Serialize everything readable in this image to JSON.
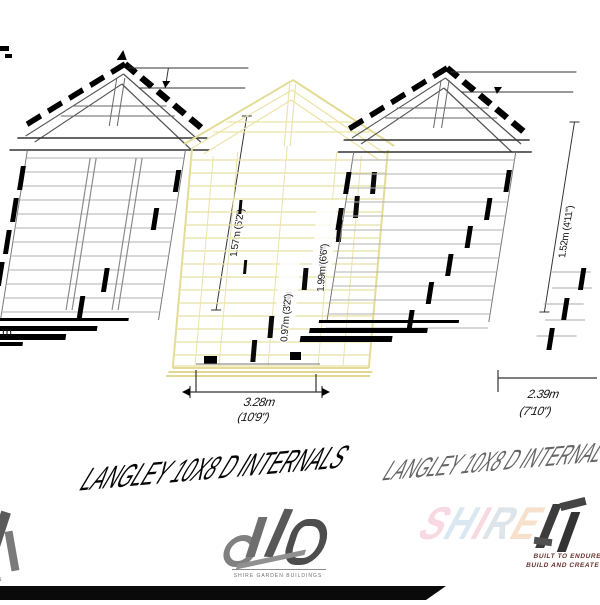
{
  "titles": {
    "primary": "LANGLEY 10X8 D INTERNALS",
    "secondary": "LANGLEY 10X8 D INTERNALS"
  },
  "dimensions": {
    "left_height": "1.57m (5'2\")",
    "mid_label_1": "1.99m (6'6\")",
    "mid_label_2": "0.97m (3'2\")",
    "mid_width_m": "3.28m",
    "mid_width_ft": "(10'9\")",
    "right_height": "1.52m (4'11\")",
    "right_width_m": "2.39m",
    "right_width_ft": "(7'10\")",
    "left_edge_fragment": "m"
  },
  "watermarks": {
    "center_small_text": "SHIRE GARDEN BUILDINGS",
    "left_small_text": "ON",
    "right_brand_letters": [
      "S",
      "H",
      "I",
      "R",
      "E"
    ],
    "right_tagline_1": "BUILT TO ENDURE",
    "right_tagline_2": "BUILD AND CREATE"
  },
  "colors": {
    "drawing_stroke": "#1a1a1a",
    "cladding_stroke": "#b0b0b0",
    "mid_elevation_stroke": "#e6df9e",
    "bottom_bar": "#0a0a0a",
    "brand_pink": "#f3b9c9",
    "brand_blue": "#bed6e8",
    "brand_peach": "#f3c9a4",
    "tagline_color": "#6b3530"
  }
}
